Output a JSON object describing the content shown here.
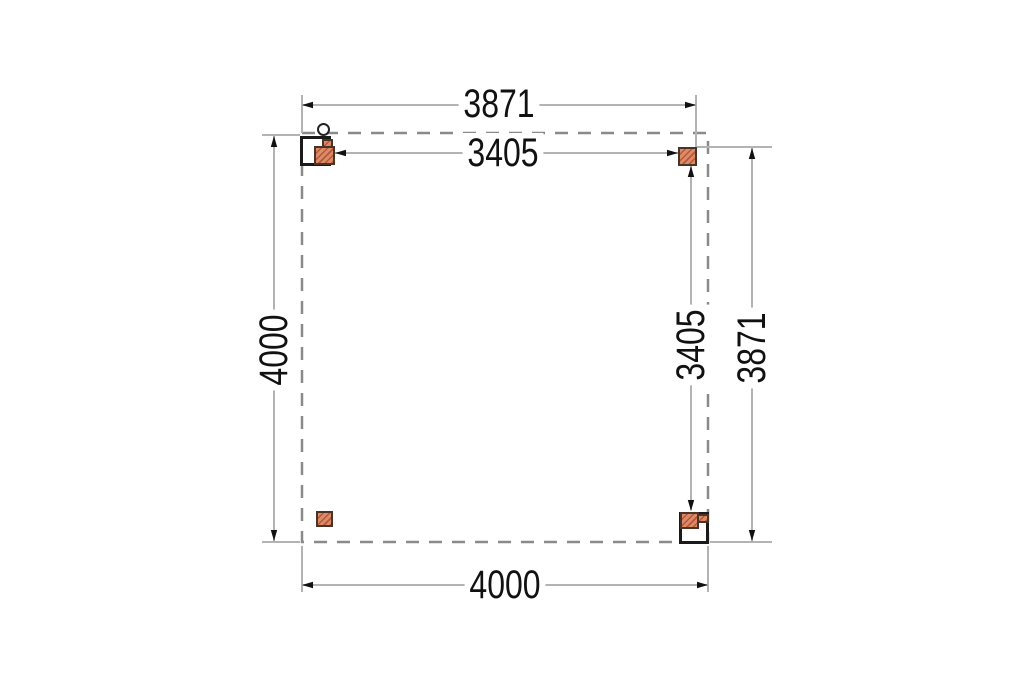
{
  "diagram": {
    "type": "floor-plan",
    "description": "Square canopy/carport plan view with four posts and dimension lines",
    "dimension_labels": {
      "top_outer": "3871",
      "top_inner": "3405",
      "left_outer": "4000",
      "right_inner": "3405",
      "right_outer": "3871",
      "bottom_outer": "4000"
    },
    "colors": {
      "background": "#ffffff",
      "post_fill": "#dd8a68",
      "post_hatch": "#b45938",
      "post_border": "#4a3428",
      "frame_stroke": "#1a1a1a",
      "dashed_outline": "#8a8a8a",
      "dimension_line": "#b3b3b3",
      "arrow_and_text": "#111111"
    }
  }
}
